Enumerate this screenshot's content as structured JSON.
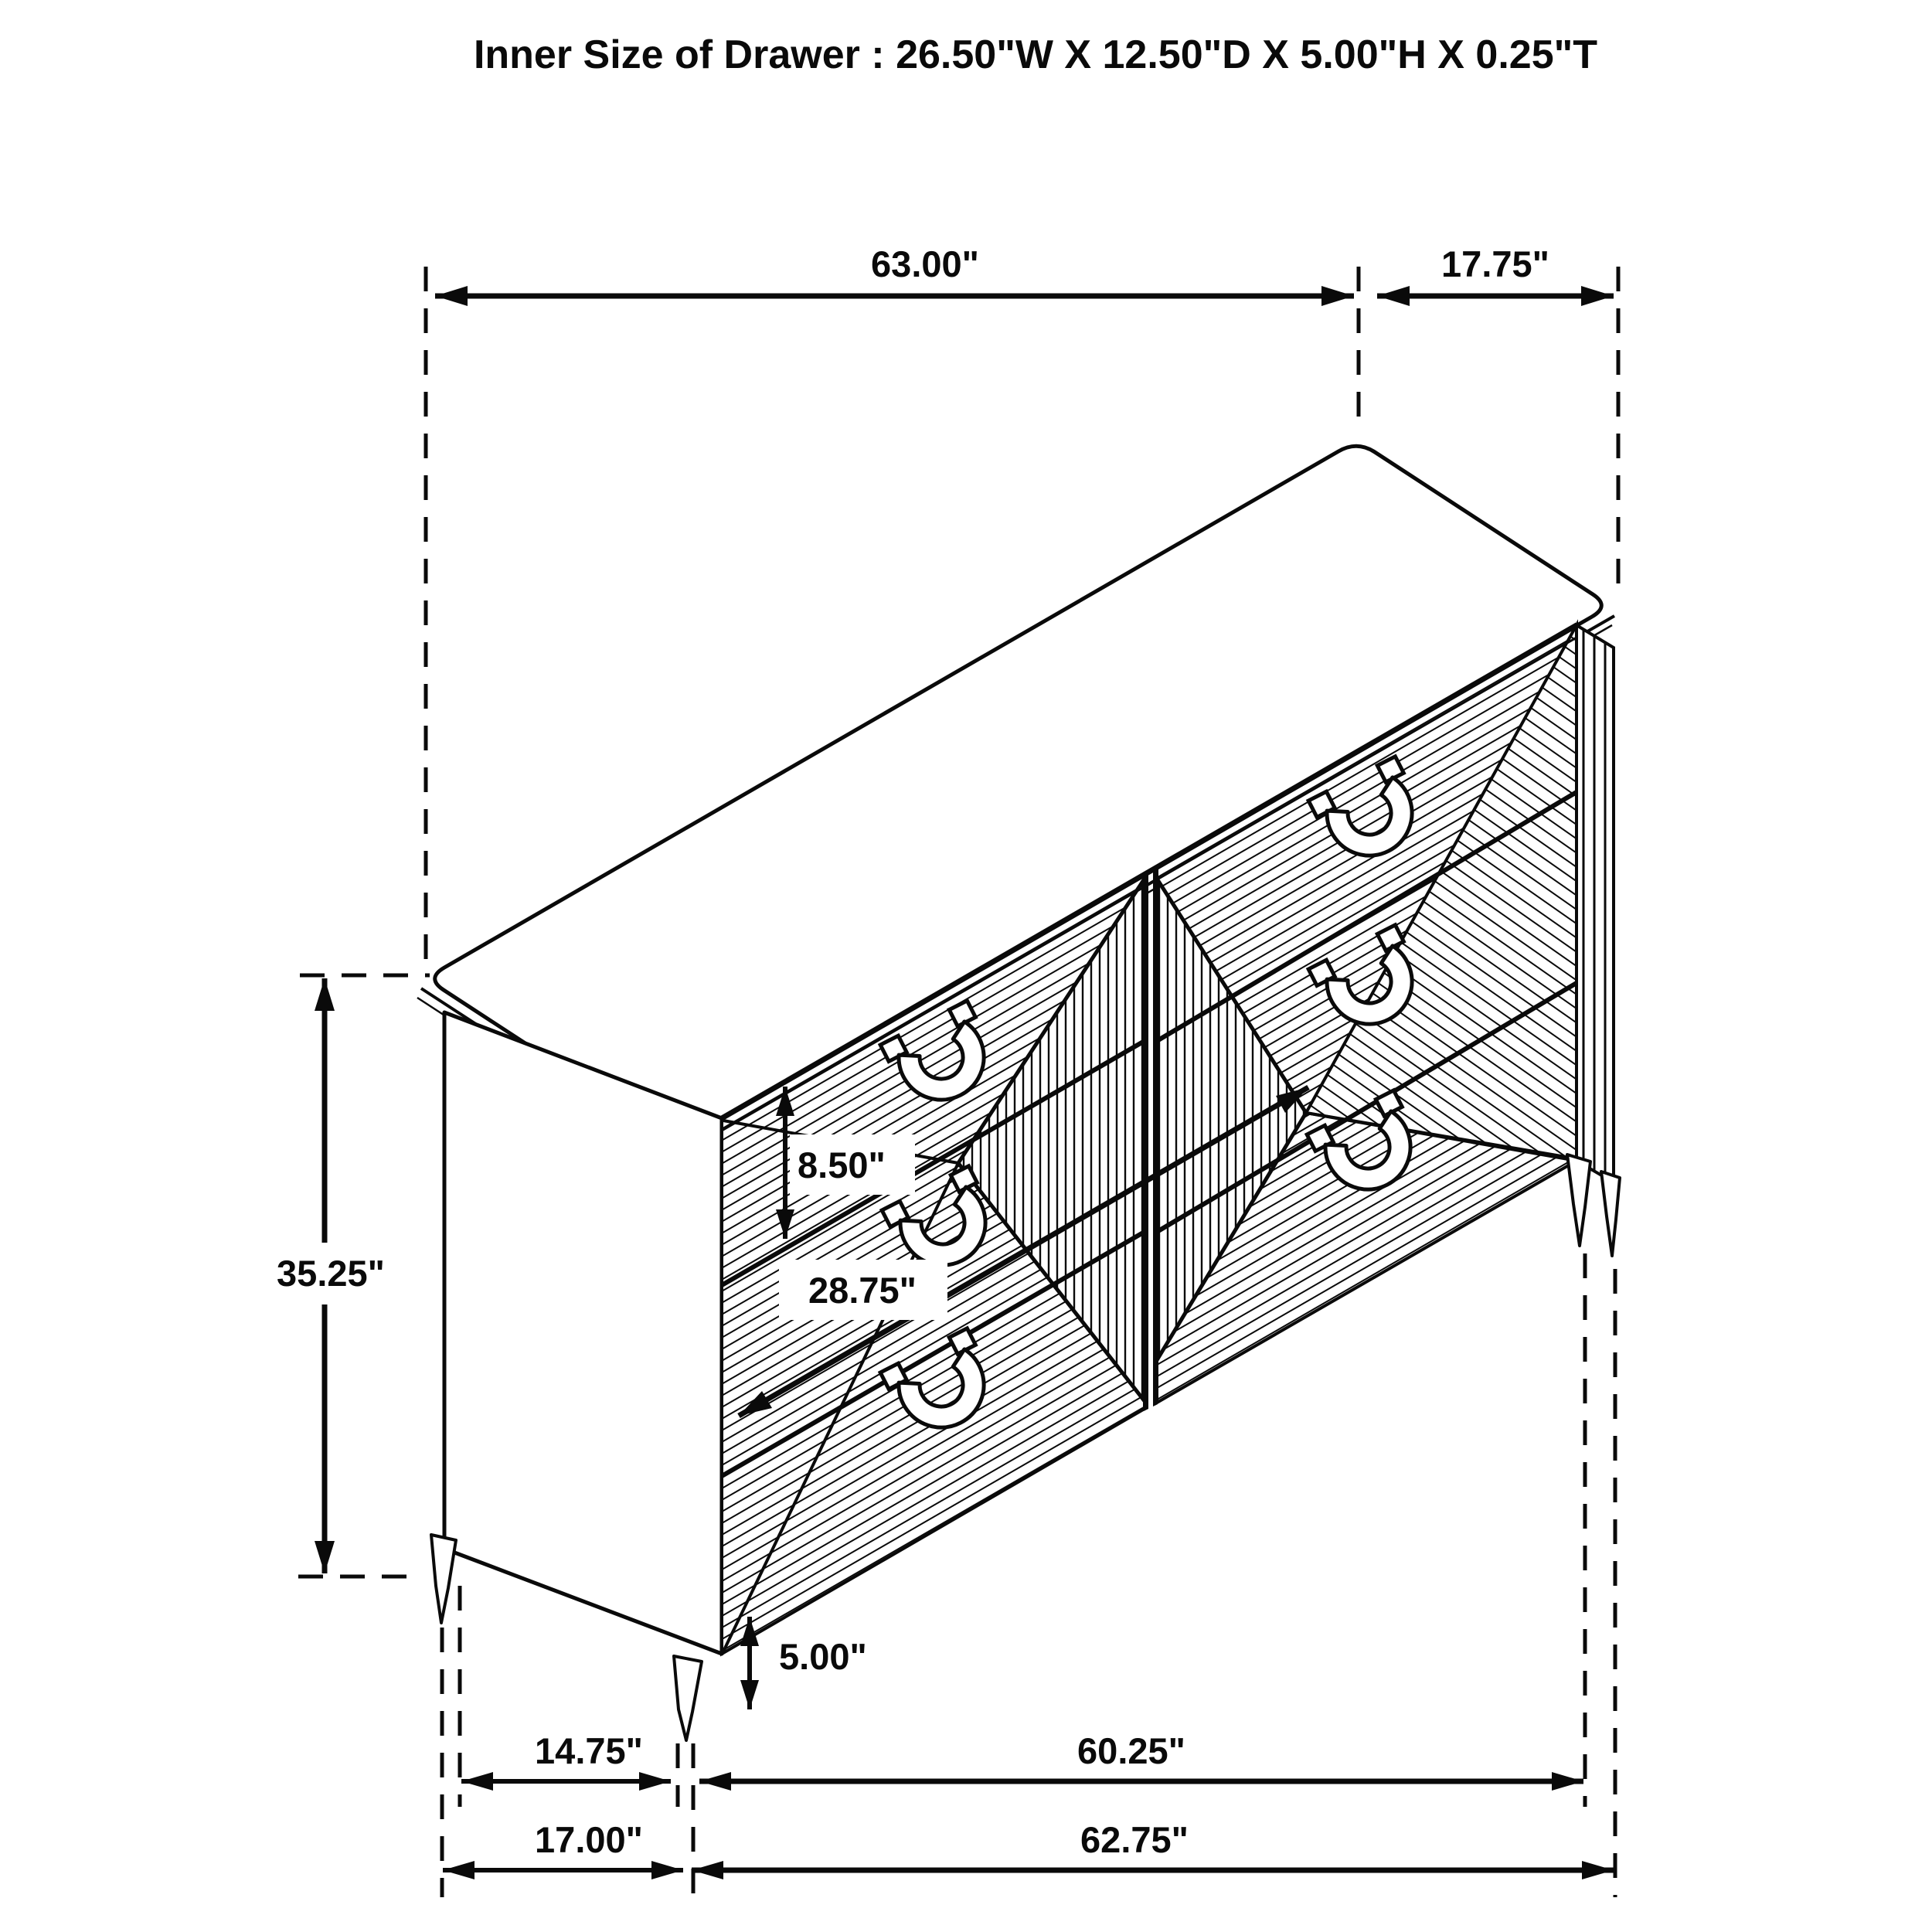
{
  "title": "Inner Size of Drawer : 26.50\"W X 12.50\"D X 5.00\"H X 0.25\"T",
  "dimensions": {
    "top_width": "63.00\"",
    "top_depth": "17.75\"",
    "total_height": "35.25\"",
    "drawer_front_height": "8.50\"",
    "drawer_inner_width": "28.75\"",
    "leg_height": "5.00\"",
    "side_leg_span": "14.75\"",
    "front_leg_span": "60.25\"",
    "side_total_depth": "17.00\"",
    "front_total_width": "62.75\""
  }
}
